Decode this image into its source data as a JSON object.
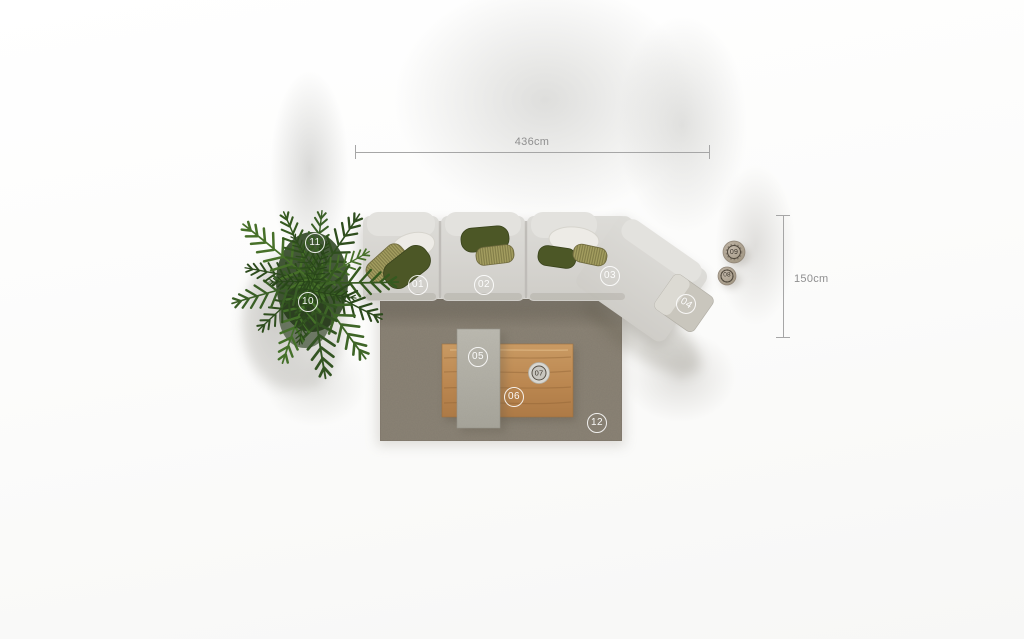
{
  "dimension_annotations": {
    "horizontal_length": "436cm",
    "vertical_depth": "150cm"
  },
  "markers": [
    {
      "number": "01",
      "item": "sofa-module-left"
    },
    {
      "number": "02",
      "item": "sofa-module-middle"
    },
    {
      "number": "03",
      "item": "sofa-module-angled"
    },
    {
      "number": "04",
      "item": "sofa-corner-side-module"
    },
    {
      "number": "05",
      "item": "concrete-tray-table"
    },
    {
      "number": "06",
      "item": "wooden-coffee-table"
    },
    {
      "number": "07",
      "item": "table-decor-bowl"
    },
    {
      "number": "08",
      "item": "side-decor-small"
    },
    {
      "number": "09",
      "item": "side-decor-large"
    },
    {
      "number": "10",
      "item": "plant-lower"
    },
    {
      "number": "11",
      "item": "plant-upper"
    },
    {
      "number": "12",
      "item": "rug"
    }
  ],
  "palette": {
    "sofa": "#d6d5d0",
    "sofa_back_cushion": "#e2e1dd",
    "pillow_dark_green": "#4c5726",
    "pillow_knit_olive": "#a8a263",
    "pillow_white": "#edebe6",
    "rug": "#8b8376",
    "wood_table": "#bd8b55",
    "concrete_table": "#b2b0a6",
    "plant_green": "#3e6527",
    "dimension_line": "#a6a6a6",
    "dimension_text": "#8f8f8f",
    "background": "#fafafa"
  }
}
